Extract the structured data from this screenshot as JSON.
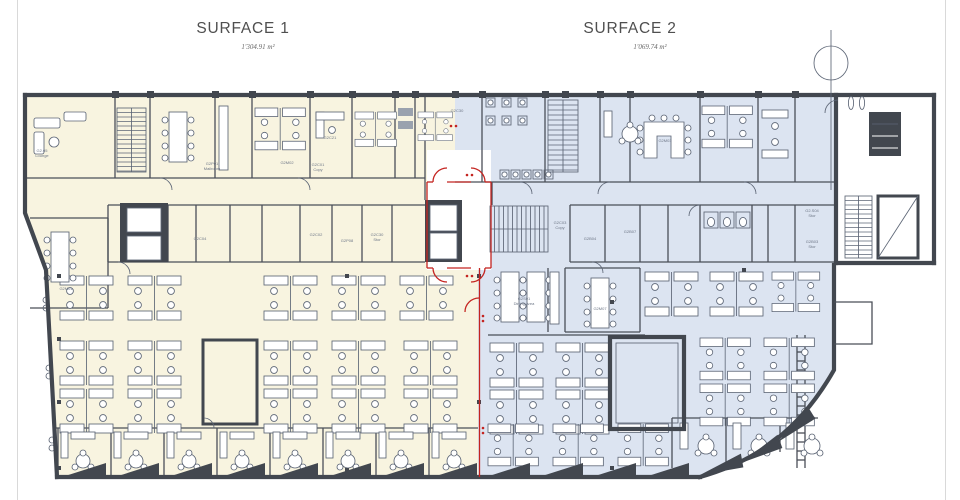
{
  "page": {
    "surface1": {
      "title": "SURFACE 1",
      "area": "1'304.91 m²"
    },
    "surface2": {
      "title": "SURFACE 2",
      "area": "1'069.74 m²"
    }
  },
  "rooms": {
    "lounge": {
      "code": "G2.05",
      "name": "Lounge"
    },
    "mailroom": {
      "code": "G2P01",
      "name": "Mailroom"
    },
    "g2c21": {
      "code": "G2C21",
      "name": ""
    },
    "g2m02": {
      "code": "G2M02",
      "name": ""
    },
    "g2c01": {
      "code": "G2C01",
      "name": "Copy"
    },
    "g2m01": {
      "code": "G2M01",
      "name": ""
    },
    "g2c04": {
      "code": "G2C04",
      "name": ""
    },
    "g2c02": {
      "code": "G2C02",
      "name": ""
    },
    "g2p08": {
      "code": "G2P08",
      "name": ""
    },
    "g2c30": {
      "code": "G2C30",
      "name": "Stor"
    },
    "g2c30b": {
      "code": "G2C30",
      "name": ""
    },
    "g2c03": {
      "code": "G2C03",
      "name": "Copy"
    },
    "g2s01": {
      "code": "G2S01",
      "name": "Dining Area"
    },
    "g2m07": {
      "code": "G2M07",
      "name": ""
    },
    "g2m03": {
      "code": "G2M03",
      "name": ""
    },
    "g2b04": {
      "code": "G2B04",
      "name": ""
    },
    "g2b07": {
      "code": "G2B07",
      "name": ""
    },
    "g2s04": {
      "code": "G2.S04",
      "name": "Stor"
    },
    "g2b03": {
      "code": "G2B03",
      "name": "Stor"
    }
  },
  "colors": {
    "surface1_fill": "#f8f4e0",
    "surface2_fill": "#dce4f1",
    "wall": "#42474f",
    "furniture_line": "#5d6676",
    "boundary_red": "#c42420"
  }
}
